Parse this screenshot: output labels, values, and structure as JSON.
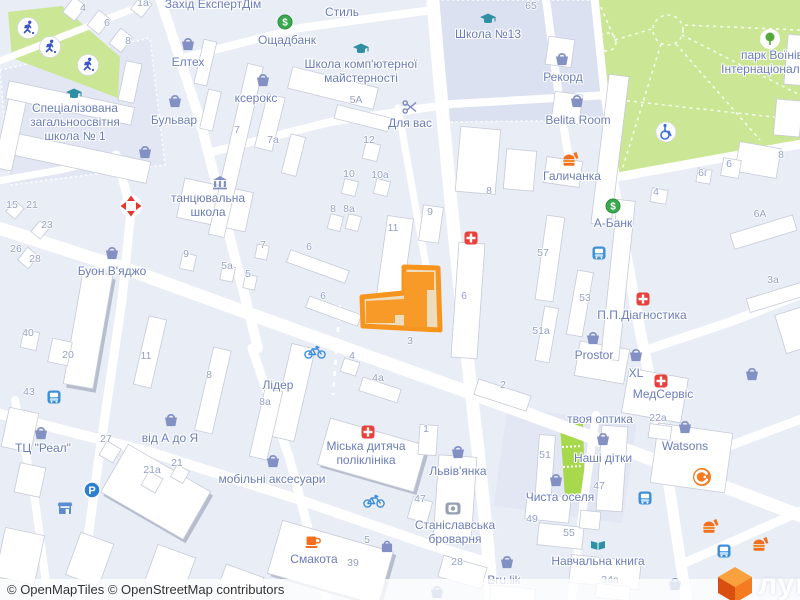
{
  "attribution": {
    "text": "© OpenMapTiles © OpenStreetMap contributors"
  },
  "watermark": {
    "text": "лун"
  },
  "colors": {
    "background": "#e9edf6",
    "park_green": "#cbe795",
    "bright_green": "#a8d84b",
    "road": "#ffffff",
    "building": "#ffffff",
    "block_lavender": "#dbe1f0",
    "highlight_orange": "#f7941e",
    "highlight_fill": "#eedcbc",
    "poi_label": "#6b7db8",
    "number_label": "#94a1c4",
    "medical_red": "#e8413c",
    "bank_green": "#3aa94d",
    "brand_orange": "#f47b20"
  },
  "map": {
    "pois": [
      {
        "id": "zahid-ekspertdim",
        "lines": [
          "Захід ЕкспертДім"
        ],
        "x": 213,
        "y": 4
      },
      {
        "id": "styl",
        "lines": [
          "Стиль"
        ],
        "x": 342,
        "y": 12
      },
      {
        "id": "oschadbank",
        "lines": [
          "Ощадбанк"
        ],
        "x": 287,
        "y": 40
      },
      {
        "id": "shkola-13",
        "lines": [
          "Школа №13"
        ],
        "x": 488,
        "y": 34
      },
      {
        "id": "park-voiniv",
        "lines": [
          "парк Воїнів",
          "Інтернаціоналістів"
        ],
        "x": 772,
        "y": 62
      },
      {
        "id": "elteh",
        "lines": [
          "Елтех"
        ],
        "x": 188,
        "y": 62
      },
      {
        "id": "shkola-kompiuternoi",
        "lines": [
          "Школа комп'ютерної",
          "майстерності"
        ],
        "x": 361,
        "y": 71
      },
      {
        "id": "kseroks",
        "lines": [
          "ксерокс"
        ],
        "x": 256,
        "y": 98
      },
      {
        "id": "rekord",
        "lines": [
          "Рекорд"
        ],
        "x": 563,
        "y": 77
      },
      {
        "id": "shkola-1",
        "lines": [
          "Спеціалізована",
          "загальноосвітня",
          "школа № 1"
        ],
        "x": 75,
        "y": 122
      },
      {
        "id": "bulvar",
        "lines": [
          "Бульвар"
        ],
        "x": 174,
        "y": 120
      },
      {
        "id": "belita-room",
        "lines": [
          "Belita Room"
        ],
        "x": 578,
        "y": 120
      },
      {
        "id": "dlia-vas",
        "lines": [
          "Для вас"
        ],
        "x": 410,
        "y": 123
      },
      {
        "id": "halychanka",
        "lines": [
          "Галичанка"
        ],
        "x": 572,
        "y": 176
      },
      {
        "id": "tantsiuvalna-shkola",
        "lines": [
          "танцювальна",
          "школа"
        ],
        "x": 208,
        "y": 205
      },
      {
        "id": "a-bank",
        "lines": [
          "А-Банк"
        ],
        "x": 613,
        "y": 223
      },
      {
        "id": "buon-viadzho",
        "lines": [
          "Буон В'яджо"
        ],
        "x": 112,
        "y": 271
      },
      {
        "id": "pp-diahnostyka",
        "lines": [
          "П.П.Діагностика"
        ],
        "x": 642,
        "y": 315
      },
      {
        "id": "prostor",
        "lines": [
          "Prostor"
        ],
        "x": 594,
        "y": 355
      },
      {
        "id": "xl",
        "lines": [
          "XL"
        ],
        "x": 636,
        "y": 373
      },
      {
        "id": "medservis",
        "lines": [
          "МедСервіс"
        ],
        "x": 663,
        "y": 394
      },
      {
        "id": "lider",
        "lines": [
          "Лідер"
        ],
        "x": 278,
        "y": 385
      },
      {
        "id": "tvoia-optyka",
        "lines": [
          "твоя оптика"
        ],
        "x": 600,
        "y": 419
      },
      {
        "id": "watsons",
        "lines": [
          "Watsons"
        ],
        "x": 685,
        "y": 446
      },
      {
        "id": "vid-a-do-ya",
        "lines": [
          "від А до Я"
        ],
        "x": 170,
        "y": 438
      },
      {
        "id": "tts-real",
        "lines": [
          "ТЦ \"Реал\""
        ],
        "x": 43,
        "y": 448
      },
      {
        "id": "nashi-ditky",
        "lines": [
          "Наші дітки"
        ],
        "x": 603,
        "y": 458
      },
      {
        "id": "miska-dytiacha-poliklinika",
        "lines": [
          "Міська дитяча",
          "поліклініка"
        ],
        "x": 366,
        "y": 453
      },
      {
        "id": "lvivianka",
        "lines": [
          "Львів'янка"
        ],
        "x": 458,
        "y": 471
      },
      {
        "id": "mobilni-aksesuary",
        "lines": [
          "мобільні аксесуари"
        ],
        "x": 272,
        "y": 479
      },
      {
        "id": "chysta-oselia",
        "lines": [
          "Чиста оселя"
        ],
        "x": 560,
        "y": 497
      },
      {
        "id": "stanislavska-brovarnia",
        "lines": [
          "Станіславська",
          "броварня"
        ],
        "x": 455,
        "y": 532
      },
      {
        "id": "smakota",
        "lines": [
          "Смакота"
        ],
        "x": 314,
        "y": 559
      },
      {
        "id": "navchalna-knyha",
        "lines": [
          "Навчальна книга"
        ],
        "x": 598,
        "y": 561
      },
      {
        "id": "bru-lik",
        "lines": [
          "Bru.lik"
        ],
        "x": 504,
        "y": 580
      }
    ],
    "numbers": [
      {
        "v": "4",
        "x": 83,
        "y": 8
      },
      {
        "v": "6",
        "x": 107,
        "y": 23
      },
      {
        "v": "8",
        "x": 128,
        "y": 41
      },
      {
        "v": "1а",
        "x": 143,
        "y": 3
      },
      {
        "v": "65",
        "x": 531,
        "y": 6
      },
      {
        "v": "7а",
        "x": 273,
        "y": 140
      },
      {
        "v": "7",
        "x": 237,
        "y": 130
      },
      {
        "v": "5А",
        "x": 356,
        "y": 100
      },
      {
        "v": "12",
        "x": 369,
        "y": 140
      },
      {
        "v": "10",
        "x": 349,
        "y": 174
      },
      {
        "v": "10а",
        "x": 380,
        "y": 175
      },
      {
        "v": "8",
        "x": 333,
        "y": 209
      },
      {
        "v": "8а",
        "x": 349,
        "y": 209
      },
      {
        "v": "9",
        "x": 430,
        "y": 212
      },
      {
        "v": "11",
        "x": 393,
        "y": 228
      },
      {
        "v": "6",
        "x": 309,
        "y": 247
      },
      {
        "v": "6",
        "x": 323,
        "y": 296
      },
      {
        "v": "6",
        "x": 464,
        "y": 296
      },
      {
        "v": "3",
        "x": 410,
        "y": 341
      },
      {
        "v": "4",
        "x": 352,
        "y": 356
      },
      {
        "v": "4а",
        "x": 378,
        "y": 378
      },
      {
        "v": "2",
        "x": 503,
        "y": 385
      },
      {
        "v": "8",
        "x": 489,
        "y": 191
      },
      {
        "v": "8",
        "x": 781,
        "y": 155
      },
      {
        "v": "6",
        "x": 729,
        "y": 164
      },
      {
        "v": "6г",
        "x": 703,
        "y": 173
      },
      {
        "v": "4",
        "x": 656,
        "y": 192
      },
      {
        "v": "6А",
        "x": 760,
        "y": 214
      },
      {
        "v": "3а",
        "x": 773,
        "y": 280
      },
      {
        "v": "57",
        "x": 543,
        "y": 253
      },
      {
        "v": "53",
        "x": 585,
        "y": 298
      },
      {
        "v": "51а",
        "x": 541,
        "y": 331
      },
      {
        "v": "15",
        "x": 12,
        "y": 205
      },
      {
        "v": "21",
        "x": 32,
        "y": 205
      },
      {
        "v": "23",
        "x": 47,
        "y": 225
      },
      {
        "v": "26",
        "x": 16,
        "y": 249
      },
      {
        "v": "28",
        "x": 35,
        "y": 259
      },
      {
        "v": "40",
        "x": 28,
        "y": 333
      },
      {
        "v": "20",
        "x": 68,
        "y": 355
      },
      {
        "v": "43",
        "x": 29,
        "y": 392
      },
      {
        "v": "9",
        "x": 186,
        "y": 254
      },
      {
        "v": "5а",
        "x": 227,
        "y": 266
      },
      {
        "v": "5",
        "x": 248,
        "y": 274
      },
      {
        "v": "7",
        "x": 263,
        "y": 245
      },
      {
        "v": "11",
        "x": 146,
        "y": 356
      },
      {
        "v": "8",
        "x": 209,
        "y": 375
      },
      {
        "v": "8а",
        "x": 265,
        "y": 402
      },
      {
        "v": "27",
        "x": 106,
        "y": 439
      },
      {
        "v": "21а",
        "x": 152,
        "y": 470
      },
      {
        "v": "21",
        "x": 177,
        "y": 463
      },
      {
        "v": "1",
        "x": 426,
        "y": 429
      },
      {
        "v": "47",
        "x": 420,
        "y": 499
      },
      {
        "v": "5",
        "x": 367,
        "y": 540
      },
      {
        "v": "39",
        "x": 353,
        "y": 563
      },
      {
        "v": "28",
        "x": 457,
        "y": 562
      },
      {
        "v": "22а",
        "x": 658,
        "y": 418
      },
      {
        "v": "51",
        "x": 545,
        "y": 455
      },
      {
        "v": "47",
        "x": 599,
        "y": 486
      },
      {
        "v": "49",
        "x": 532,
        "y": 519
      },
      {
        "v": "55",
        "x": 569,
        "y": 533
      },
      {
        "v": "34а",
        "x": 610,
        "y": 580
      }
    ],
    "markers": [
      {
        "type": "basket",
        "x": 188,
        "y": 44
      },
      {
        "type": "basket",
        "x": 263,
        "y": 80
      },
      {
        "type": "basket",
        "x": 175,
        "y": 101
      },
      {
        "type": "basket",
        "x": 145,
        "y": 152
      },
      {
        "type": "basket",
        "x": 112,
        "y": 253
      },
      {
        "type": "basket",
        "x": 562,
        "y": 59
      },
      {
        "type": "basket",
        "x": 577,
        "y": 101
      },
      {
        "type": "basket",
        "x": 171,
        "y": 420
      },
      {
        "type": "basket",
        "x": 41,
        "y": 433
      },
      {
        "type": "basket",
        "x": 273,
        "y": 461
      },
      {
        "type": "basket",
        "x": 458,
        "y": 452
      },
      {
        "type": "basket",
        "x": 507,
        "y": 562
      },
      {
        "type": "basket",
        "x": 437,
        "y": 592
      },
      {
        "type": "basket",
        "x": 675,
        "y": 584
      },
      {
        "type": "basket",
        "x": 593,
        "y": 338
      },
      {
        "type": "basket",
        "x": 636,
        "y": 355
      },
      {
        "type": "basket",
        "x": 752,
        "y": 374
      },
      {
        "type": "basket",
        "x": 685,
        "y": 427
      },
      {
        "type": "basket",
        "x": 603,
        "y": 439
      },
      {
        "type": "basket",
        "x": 556,
        "y": 480
      },
      {
        "type": "bag",
        "x": 387,
        "y": 546
      },
      {
        "type": "cap",
        "x": 74,
        "y": 94
      },
      {
        "type": "cap",
        "x": 361,
        "y": 49
      },
      {
        "type": "cap",
        "x": 488,
        "y": 19
      },
      {
        "type": "dollar",
        "x": 285,
        "y": 22
      },
      {
        "type": "dollar",
        "x": 613,
        "y": 206
      },
      {
        "type": "medical",
        "x": 471,
        "y": 238
      },
      {
        "type": "medical",
        "x": 643,
        "y": 299
      },
      {
        "type": "medical",
        "x": 661,
        "y": 381
      },
      {
        "type": "medical",
        "x": 368,
        "y": 432
      },
      {
        "type": "food",
        "x": 570,
        "y": 159
      },
      {
        "type": "food",
        "x": 710,
        "y": 526
      },
      {
        "type": "food",
        "x": 760,
        "y": 544
      },
      {
        "type": "coffee",
        "x": 313,
        "y": 542
      },
      {
        "type": "scissors",
        "x": 410,
        "y": 107
      },
      {
        "type": "bicycle",
        "x": 315,
        "y": 352
      },
      {
        "type": "bicycle",
        "x": 374,
        "y": 501
      },
      {
        "type": "bus",
        "x": 599,
        "y": 253
      },
      {
        "type": "bus",
        "x": 645,
        "y": 498
      },
      {
        "type": "bus",
        "x": 724,
        "y": 551
      },
      {
        "type": "bus",
        "x": 54,
        "y": 397
      },
      {
        "type": "parking",
        "x": 92,
        "y": 490
      },
      {
        "type": "wheelchair",
        "x": 666,
        "y": 132
      },
      {
        "type": "tree",
        "x": 770,
        "y": 39
      },
      {
        "type": "camera",
        "x": 453,
        "y": 508
      },
      {
        "type": "book",
        "x": 598,
        "y": 545
      },
      {
        "type": "runner",
        "x": 28,
        "y": 28
      },
      {
        "type": "runner",
        "x": 50,
        "y": 47
      },
      {
        "type": "runner",
        "x": 88,
        "y": 65
      },
      {
        "type": "museum",
        "x": 220,
        "y": 183
      },
      {
        "type": "store",
        "x": 65,
        "y": 508
      },
      {
        "type": "redarrows",
        "x": 131,
        "y": 206
      },
      {
        "type": "comfy",
        "x": 702,
        "y": 477
      }
    ],
    "highlight": {
      "label": "3",
      "x": 410,
      "y": 341
    }
  }
}
